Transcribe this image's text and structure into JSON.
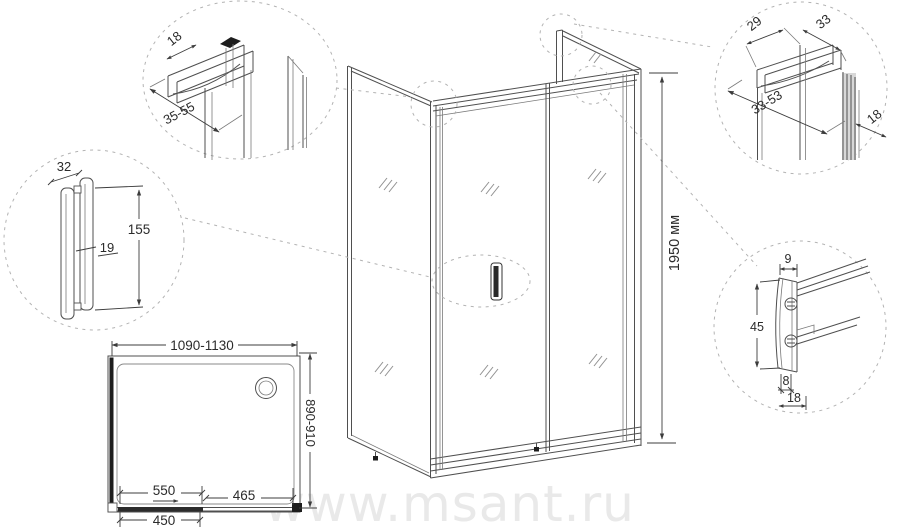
{
  "watermark": "www.msant.ru",
  "colors": {
    "line": "#4f4f4f",
    "dim_text": "#2b2b2b",
    "dashed": "#b3b3b3",
    "watermark": "#e9e9e9"
  },
  "main_view": {
    "height": "1950 мм"
  },
  "details": {
    "top_left": {
      "flange_width": "18",
      "adjust_range": "35-55"
    },
    "handle_front": {
      "width": "32",
      "height": "155",
      "grip_gap": "19"
    },
    "top_right": {
      "inner_width": "29",
      "outer_width": "33",
      "adjust_range": "33-53",
      "depth": "18"
    },
    "handle_profile": {
      "top_width": "9",
      "height": "45",
      "bottom_width": "8",
      "depth": "18"
    }
  },
  "plan_view": {
    "width_range": "1090-1130",
    "depth_range": "890-910",
    "door_width": "550",
    "fixed_panel": "465",
    "opening_width": "450"
  }
}
